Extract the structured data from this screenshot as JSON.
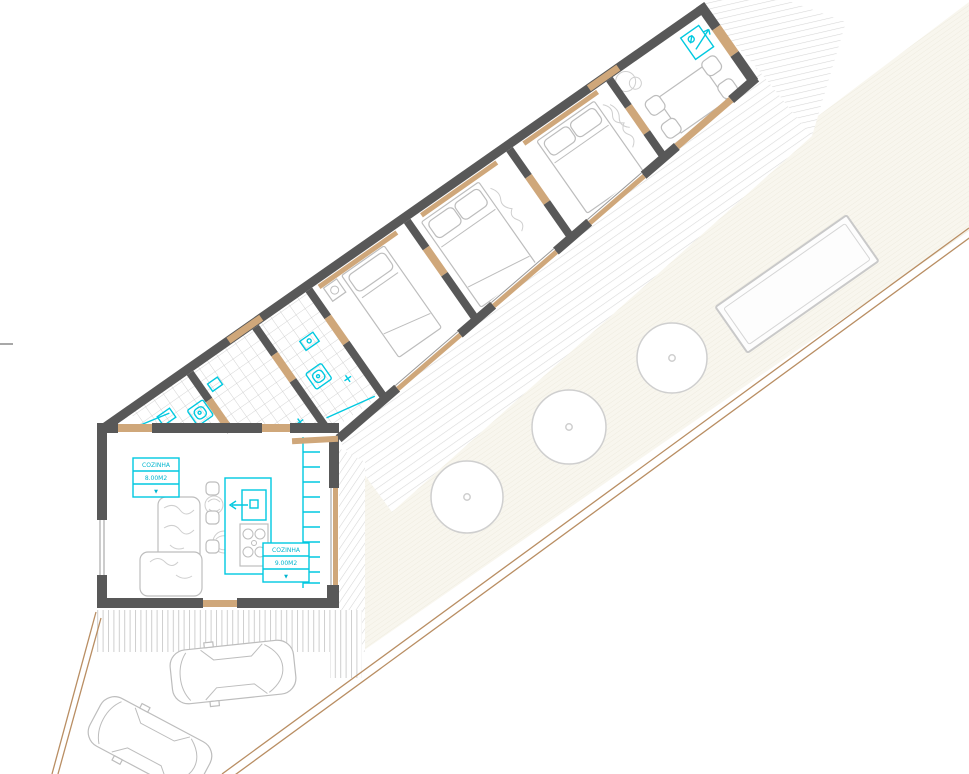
{
  "document": {
    "type": "architectural floor plan",
    "view": "rotated house wing with garden, deck, pool and driveway"
  },
  "room_labels": [
    {
      "name": "COZINHA",
      "area": "8.00M2",
      "marker": "▼"
    },
    {
      "name": "COZINHA",
      "area": "9.00M2",
      "marker": "▼"
    }
  ],
  "site_objects": {
    "trees": "3",
    "cars": "2",
    "pool": "1",
    "bedrooms": "3"
  },
  "colors": {
    "wall": "#585858",
    "fixture_cyan": "#00c9e0",
    "label_text_cyan": "#00b5cf",
    "wood_tan": "#cfa77a",
    "boundary_tan": "#b98e63",
    "furniture_gray": "#bdbdbd",
    "deck_stripe": "#dadada",
    "lawn_fill": "#f8f6ee"
  }
}
